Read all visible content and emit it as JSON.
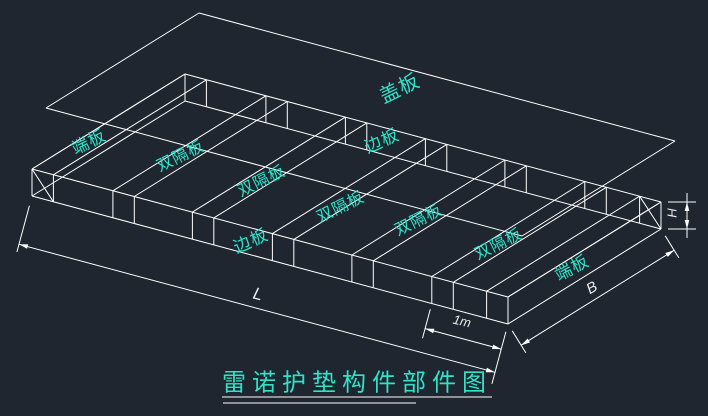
{
  "canvas": {
    "background": "#1f2630",
    "line_color": "#ffffff",
    "part_label_color": "#2fe3c9",
    "dim_label_color": "#e8e8e8",
    "title_color": "#2fe3c9"
  },
  "title": {
    "text": "雷诺护垫构件部件图"
  },
  "part_labels": [
    {
      "text": "盖板",
      "x": 400,
      "y": 89,
      "rot": -26,
      "size": 20
    },
    {
      "text": "端板",
      "x": 89,
      "y": 142,
      "rot": -26,
      "size": 17
    },
    {
      "text": "双隔板",
      "x": 181,
      "y": 157,
      "rot": -26,
      "size": 16
    },
    {
      "text": "双隔板",
      "x": 262,
      "y": 182,
      "rot": -26,
      "size": 16
    },
    {
      "text": "双隔板",
      "x": 341,
      "y": 208,
      "rot": -26,
      "size": 16
    },
    {
      "text": "双隔板",
      "x": 419,
      "y": 221,
      "rot": -26,
      "size": 16
    },
    {
      "text": "双隔板",
      "x": 499,
      "y": 245,
      "rot": -26,
      "size": 16
    },
    {
      "text": "边板",
      "x": 382,
      "y": 141,
      "rot": -24,
      "size": 17
    },
    {
      "text": "边板",
      "x": 251,
      "y": 241,
      "rot": -24,
      "size": 17
    },
    {
      "text": "端板",
      "x": 572,
      "y": 268,
      "rot": -28,
      "size": 17
    }
  ],
  "dimension_labels": [
    {
      "text": "L",
      "x": 258,
      "y": 294,
      "rot": 14,
      "size": 17
    },
    {
      "text": "B",
      "x": 592,
      "y": 288,
      "rot": -30,
      "size": 15
    },
    {
      "text": "1m",
      "x": 462,
      "y": 321,
      "rot": 13,
      "size": 13
    },
    {
      "text": "H",
      "x": 672,
      "y": 213,
      "rot": -90,
      "size": 13
    }
  ]
}
